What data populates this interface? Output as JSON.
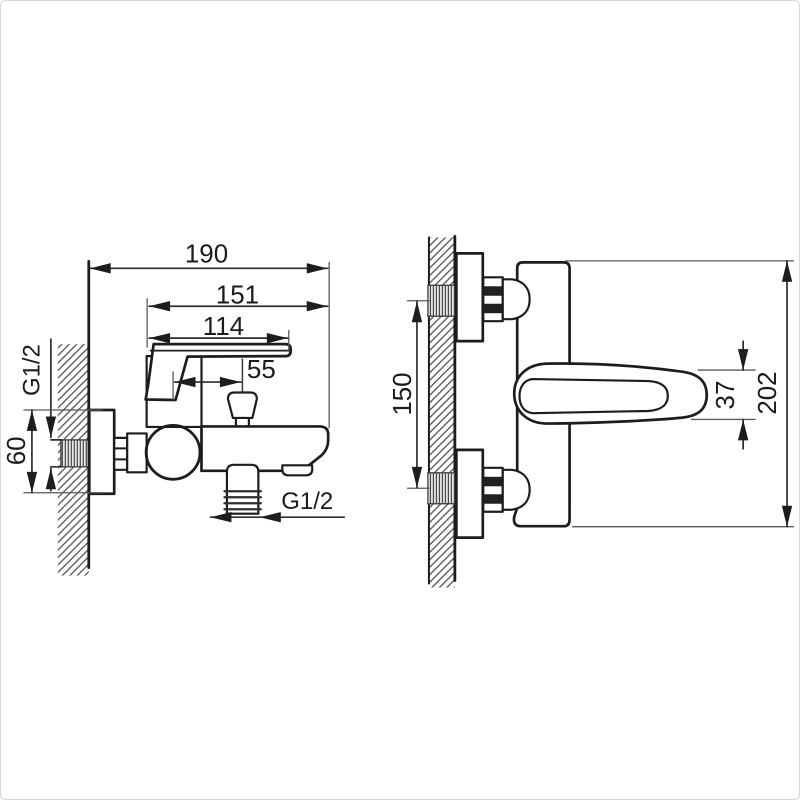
{
  "drawing": {
    "background": "#ffffff",
    "line_color": "#1d1d1d",
    "dimension_color": "#2e2e2e",
    "hatch_color": "#4d4d4d",
    "frame_border_color": "#d8d8d8"
  },
  "side_view": {
    "dims": {
      "total_depth": "190",
      "body_depth": "151",
      "spout_depth": "114",
      "diverter_offset": "55",
      "plate_height": "60",
      "wall_inlet_thread": "G1/2",
      "bottom_outlet_thread": "G1/2"
    }
  },
  "front_view": {
    "dims": {
      "inlet_spacing": "150",
      "lever_width": "37",
      "total_height": "202"
    }
  }
}
